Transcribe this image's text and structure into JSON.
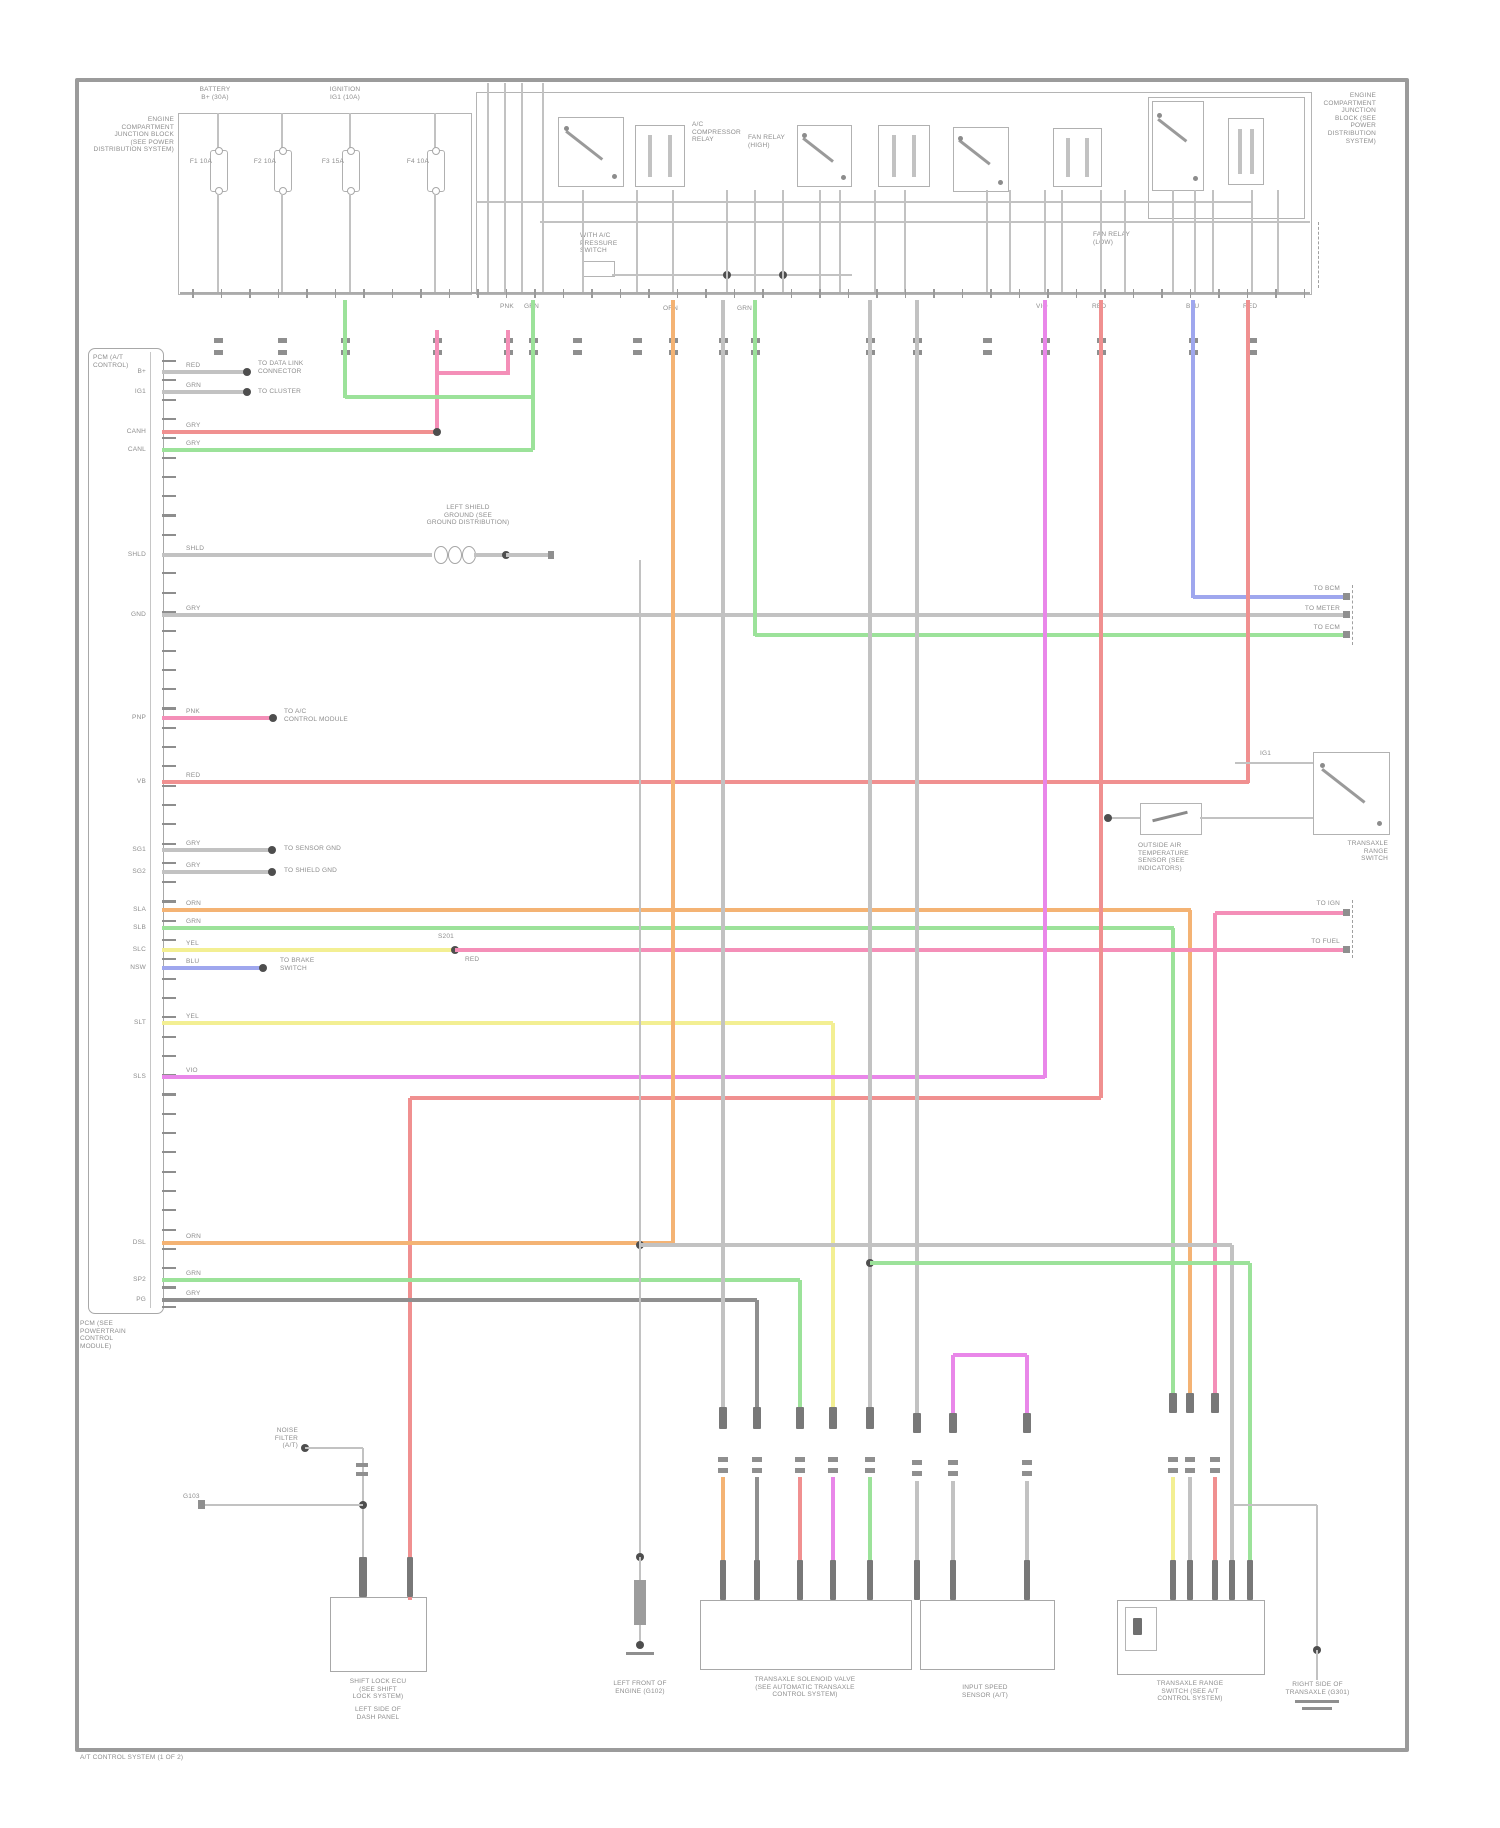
{
  "palette": {
    "gray": "#c2c2c2",
    "darkgray": "#8f8f8f",
    "busgray": "#ababab",
    "red": "#f09090",
    "pink": "#f48fb8",
    "green": "#9ce29a",
    "orange": "#f4b374",
    "yellow": "#f3ef93",
    "magenta": "#e987e9",
    "blue": "#9fa7ee"
  },
  "blocks": {
    "tl_block": {
      "lines": [
        "ENGINE",
        "COMPARTMENT",
        "JUNCTION BLOCK",
        "(SEE POWER",
        "DISTRIBUTION SYSTEM)"
      ]
    },
    "fuse_grp1": {
      "lines": [
        "BATTERY",
        "B+ (30A)"
      ]
    },
    "fuse_grp2": {
      "lines": [
        "IGNITION",
        "IG1 (10A)"
      ]
    },
    "relayA": {
      "lines": [
        "A/C",
        "COMPRESSOR",
        "RELAY"
      ]
    },
    "relayB": {
      "lines": [
        "FAN RELAY",
        "(HIGH)"
      ]
    },
    "relayC": {
      "lines": [
        "FAN RELAY",
        "(LOW)"
      ]
    },
    "mid1": {
      "lines": [
        "WITH A/C",
        "PRESSURE",
        "SWITCH"
      ]
    },
    "tr_block": {
      "lines": [
        "ENGINE",
        "COMPARTMENT",
        "JUNCTION",
        "BLOCK (SEE",
        "POWER",
        "DISTRIBUTION",
        "SYSTEM)"
      ]
    },
    "shield": {
      "lines": [
        "LEFT SHIELD",
        "GROUND (SEE",
        "GROUND DISTRIBUTION)"
      ]
    },
    "s6": {
      "lines": [
        "TO DATA LINK",
        "CONNECTOR"
      ]
    },
    "s7": {
      "lines": [
        "TO CLUSTER"
      ]
    },
    "s13": {
      "lines": [
        "TO A/C",
        "CONTROL MODULE"
      ]
    },
    "s14": {
      "lines": [
        "TO SENSOR GND"
      ]
    },
    "s15": {
      "lines": [
        "TO SHIELD GND"
      ]
    },
    "s19": {
      "lines": [
        "TO BRAKE",
        "SWITCH"
      ]
    },
    "sensor_lbl": {
      "lines": [
        "OUTSIDE AIR",
        "TEMPERATURE",
        "SENSOR (SEE",
        "INDICATORS)"
      ]
    },
    "switch_lbl": {
      "lines": [
        "TRANSAXLE",
        "RANGE",
        "SWITCH"
      ]
    },
    "ecm_title": {
      "lines": [
        "PCM (A/T",
        "CONTROL)"
      ]
    },
    "ecm_bottom": {
      "lines": [
        "PCM (SEE",
        "POWERTRAIN",
        "CONTROL",
        "MODULE)"
      ]
    },
    "g_lbl": {
      "lines": [
        "LEFT FRONT OF",
        "ENGINE (G102)"
      ]
    },
    "bl_comp": {
      "lines": [
        "NOISE",
        "FILTER",
        "(A/T)"
      ]
    },
    "bl_box1": {
      "lines": [
        "SHIFT LOCK ECU",
        "(SEE SHIFT",
        "LOCK SYSTEM)"
      ]
    },
    "bl_box2": {
      "lines": [
        "LEFT SIDE OF",
        "DASH PANEL"
      ]
    },
    "bc_box": {
      "lines": [
        "TRANSAXLE SOLENOID VALVE",
        "(SEE AUTOMATIC TRANSAXLE",
        "CONTROL SYSTEM)"
      ]
    },
    "bm_box": {
      "lines": [
        "INPUT SPEED",
        "SENSOR (A/T)"
      ]
    },
    "br_box": {
      "lines": [
        "TRANSAXLE RANGE",
        "SWITCH (SEE A/T",
        "CONTROL SYSTEM)"
      ]
    },
    "gr_right": {
      "lines": [
        "RIGHT SIDE OF",
        "TRANSAXLE (G301)"
      ]
    }
  },
  "labels": {
    "fuse1": "F1 10A",
    "fuse2": "F2 10A",
    "fuse3": "F3 15A",
    "fuse4": "F4 10A",
    "splice1": "S201",
    "splice1b": "RED",
    "ig": "IG1",
    "e_blu": "TO BCM",
    "e_gry": "TO METER",
    "e_grn": "TO ECM",
    "e_p1": "TO IGN",
    "e_p2": "TO FUEL",
    "stub1505": "G103",
    "footer": "A/T CONTROL SYSTEM (1 OF 2)"
  },
  "ecm": {
    "pins": [
      "B+",
      "IG1",
      "CANH",
      "CANL",
      "SHLD",
      "GND",
      "PNP",
      "VB",
      "SG1",
      "SG2",
      "SLA",
      "SLB",
      "SLC",
      "NSW",
      "SLT",
      "SLS",
      "DSL",
      "SP2",
      "PG"
    ],
    "codes": [
      "RED",
      "GRN",
      "GRY",
      "GRY",
      "SHLD",
      "GRY",
      "PNK",
      "RED",
      "GRY",
      "GRY",
      "ORN",
      "GRN",
      "YEL",
      "BLU",
      "YEL",
      "VIO",
      "ORN",
      "GRN",
      "GRY"
    ]
  },
  "bus_codes": [
    "PNK",
    "GRN",
    "ORN",
    "GRN",
    "VIO",
    "RED",
    "BLU",
    "RED"
  ]
}
